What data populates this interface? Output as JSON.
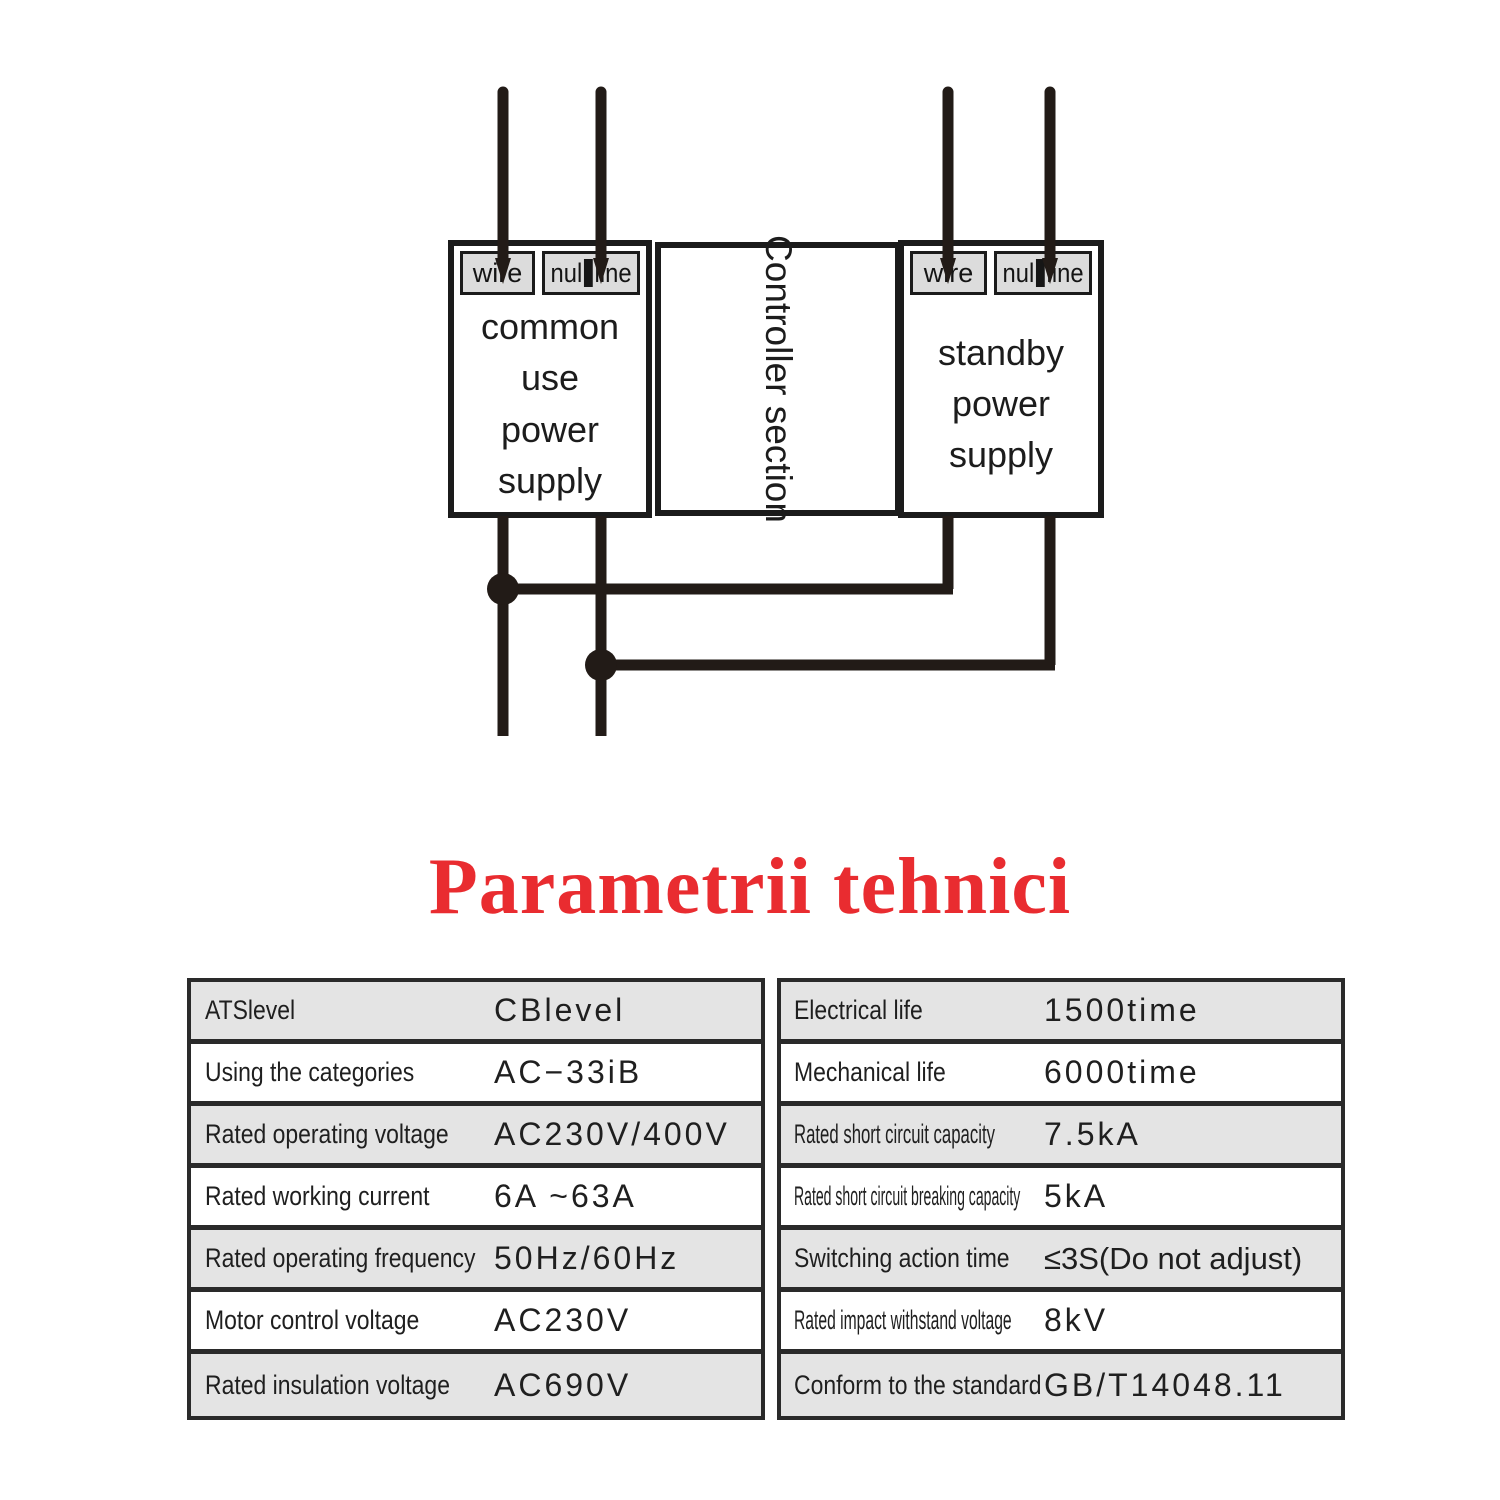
{
  "colors": {
    "title_red": "#e92c30",
    "wire_black": "#221b17",
    "box_border": "#1b1b1b",
    "terminal_gray": "#dcdcdc",
    "table_row_gray": "#e4e4e4",
    "table_border": "#2a2a2a"
  },
  "diagram": {
    "left_box": {
      "line1": "common use",
      "line2": "power supply"
    },
    "controller_box": {
      "label": "Controller section"
    },
    "right_box": {
      "line1": "standby",
      "line2": "power",
      "line3": "supply"
    },
    "terminals": {
      "wire": "wire",
      "null_prefix": "nul",
      "null_suffix": "line"
    }
  },
  "title": "Parametrii tehnici",
  "tables": {
    "left": {
      "rows": [
        {
          "label": "ATSlevel",
          "value": "CBlevel"
        },
        {
          "label": "Using the categories",
          "value": "AC−33iB"
        },
        {
          "label": "Rated operating voltage",
          "value": "AC230V/400V"
        },
        {
          "label": "Rated working current",
          "value": "6A ~63A"
        },
        {
          "label": "Rated operating frequency",
          "value": "50Hz/60Hz"
        },
        {
          "label": "Motor control voltage",
          "value": "AC230V"
        },
        {
          "label": "Rated insulation voltage",
          "value": "AC690V"
        }
      ]
    },
    "right": {
      "rows": [
        {
          "label": "Electrical life",
          "value": "1500time"
        },
        {
          "label": "Mechanical life",
          "value": "6000time"
        },
        {
          "label": "Rated short circuit capacity",
          "value": "7.5kA"
        },
        {
          "label": "Rated short circuit breaking capacity",
          "value": "5kA"
        },
        {
          "label": "Switching action time",
          "value": "≤3S(Do not adjust)"
        },
        {
          "label": "Rated impact withstand voltage",
          "value": "8kV"
        },
        {
          "label": "Conform to the standard",
          "value": "GB/T14048.11"
        }
      ]
    }
  }
}
